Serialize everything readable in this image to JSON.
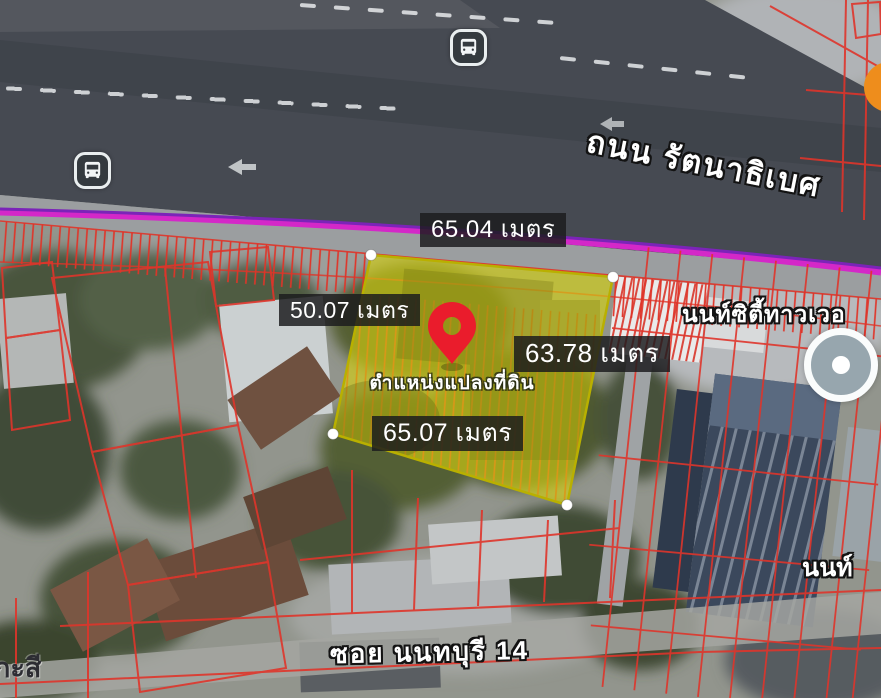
{
  "map_annotations": {
    "measurement_top": "65.04 เมตร",
    "measurement_left": "50.07 เมตร",
    "measurement_right": "63.78 เมตร",
    "measurement_bottom": "65.07 เมตร",
    "pin_caption": "ตำแหน่งแปลงที่ดิน",
    "road_name": "ถนน รัตนาธิเบศ",
    "soi_name": "ซอย นนทบุรี 14",
    "building_name": "นนท์ซิตี้ทาวเวอ",
    "place_partial_right": "นนท์",
    "place_partial_left": "กะสี"
  },
  "icons": {
    "transit_station_top": "bus-station-icon",
    "transit_station_left": "bus-station-icon",
    "poi_right": "poi-circle-icon",
    "poi_top_right": "poi-orange-icon",
    "marker": "location-pin-icon"
  },
  "colors": {
    "plot_fill": "#d8d30f",
    "plot_border": "#b9b000",
    "parcel_line": "#df352b",
    "transit_line_magenta": "#d428c8",
    "transit_line_purple": "#7b24b8",
    "pin_red": "#ea1c2c",
    "label_background": "rgba(28,28,30,0.84)",
    "label_text": "#ffffff",
    "poi_orange": "#ee8d1c",
    "road_surface": "#464a52"
  }
}
